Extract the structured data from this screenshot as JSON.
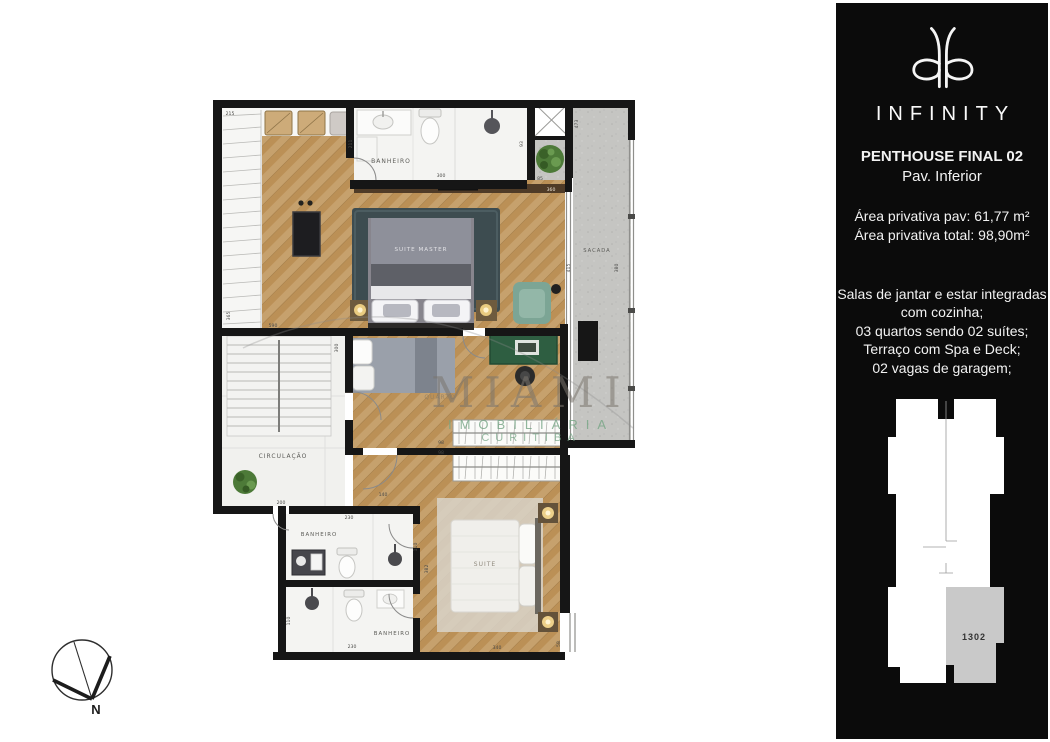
{
  "sidebar": {
    "brand": "INFINITY",
    "title_line1": "PENTHOUSE FINAL 02",
    "title_line2": "Pav. Inferior",
    "area_line1": "Área privativa pav: 61,77 m²",
    "area_line2": "Área privativa total: 98,90m²",
    "features": [
      "Salas de jantar e estar integradas",
      "com cozinha;",
      "03 quartos sendo 02 suítes;",
      "Terraço com Spa e Deck;",
      "02 vagas de garagem;"
    ],
    "keyplan_unit": "1302"
  },
  "plan": {
    "rooms": {
      "banheiro_top": "BANHEIRO",
      "suite_master": "SUITE MASTER",
      "sacada": "SACADA",
      "quarto": "QUARTO",
      "circulacao": "CIRCULAÇÃO",
      "banheiro_mid": "BANHEIRO",
      "banheiro_bottom": "BANHEIRO",
      "suite": "SUITE"
    },
    "dims": [
      "215",
      "211",
      "300",
      "93",
      "85",
      "473",
      "415",
      "380",
      "360",
      "365",
      "590",
      "300",
      "200",
      "140",
      "98",
      "98",
      "230",
      "110",
      "230",
      "110",
      "382",
      "340",
      "58"
    ]
  },
  "watermark": {
    "line1": "MIAMI",
    "line2": "IMOBILIÁRIA",
    "line3": "CURITIBA"
  },
  "compass": {
    "north_label": "N"
  }
}
